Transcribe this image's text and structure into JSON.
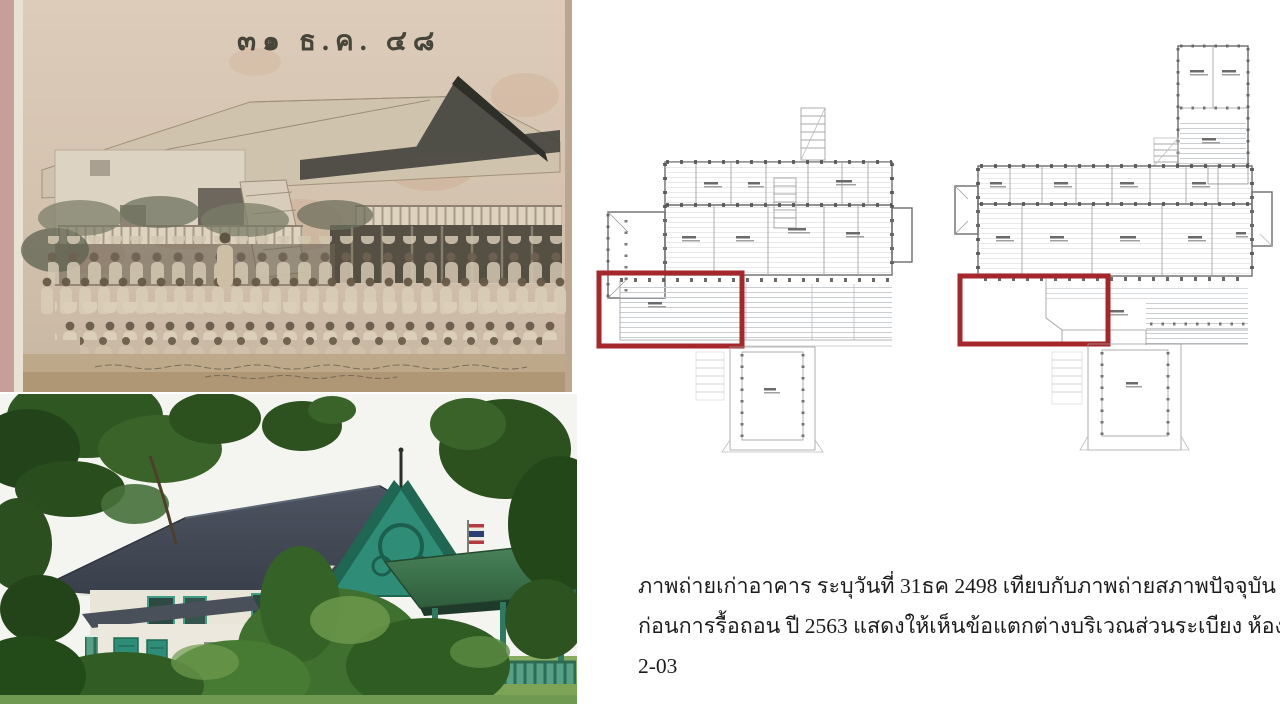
{
  "figure": {
    "old_photo": {
      "date_stamp": "๓๑ ธ.ค. ๔๘"
    },
    "caption": {
      "line1": "ภาพถ่ายเก่าอาคาร ระบุวันที่ 31ธค 2498 เทียบกับภาพถ่ายสภาพปัจจุบัน",
      "line2": "ก่อนการรื้อถอน ปี 2563  แสดงให้เห็นข้อแตกต่างบริเวณส่วนระเบียง ห้อง",
      "line3": "2-03"
    }
  },
  "colors": {
    "highlight_red": "#a5262b",
    "plan_line": "#6d6d6d",
    "plan_hatch": "#c9ced3",
    "caption_text": "#1c1c1c",
    "photo_paper": "#d6c5b1",
    "teal_trim": "#2f8d77",
    "roof_gray": "#454c57",
    "foliage_green": "#2f5a22"
  }
}
